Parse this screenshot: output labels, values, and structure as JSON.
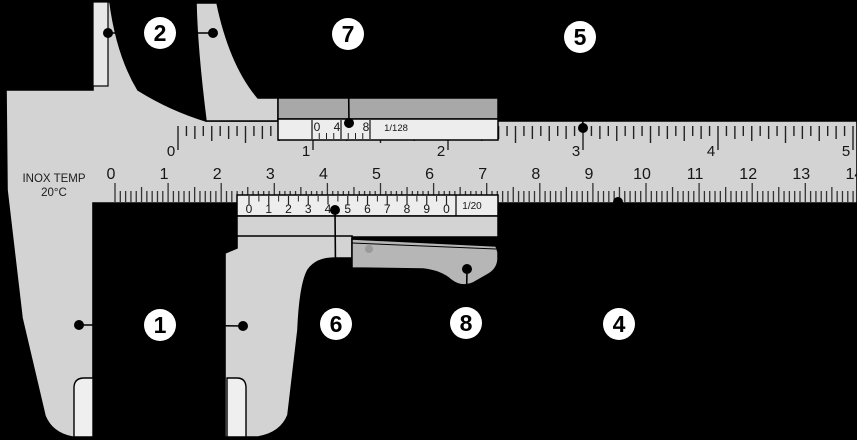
{
  "figure": {
    "type": "vernier-caliper-diagram",
    "background": "#000000"
  },
  "colors": {
    "metal": "#d3d3d3",
    "vernier_plate": "#ededed",
    "clamp_band": "#a8a8a8",
    "thumb_grip": "#b6b6b6",
    "inner_face": "#e7e7e7",
    "measuring_face": "#efefef",
    "tick": "#222222",
    "outline": "#000000",
    "callout_fill": "#ffffff",
    "callout_text": "#000000"
  },
  "engraving": {
    "line1": "INOX TEMP",
    "line2": "20°C"
  },
  "main_scale_inch": {
    "labels": [
      "0",
      "1",
      "2",
      "3",
      "4",
      "5"
    ],
    "subdivisions_per_unit": 16
  },
  "main_scale_cm": {
    "labels": [
      "0",
      "1",
      "2",
      "3",
      "4",
      "5",
      "6",
      "7",
      "8",
      "9",
      "10",
      "11",
      "12",
      "13",
      "14"
    ],
    "subdivisions_per_unit": 10
  },
  "vernier_inch": {
    "labels": [
      "0",
      "4",
      "8"
    ],
    "fraction": "1/128",
    "divisions": 8
  },
  "vernier_mm": {
    "labels": [
      "0",
      "1",
      "2",
      "3",
      "4",
      "5",
      "6",
      "7",
      "8",
      "9",
      "0"
    ],
    "fraction": "1/20",
    "divisions": 10
  },
  "callouts": [
    {
      "label": "1",
      "part": "external-jaws"
    },
    {
      "label": "2",
      "part": "internal-jaws"
    },
    {
      "label": "4",
      "part": "main-scale-cm"
    },
    {
      "label": "5",
      "part": "main-scale-inch"
    },
    {
      "label": "6",
      "part": "vernier-scale-cm"
    },
    {
      "label": "7",
      "part": "vernier-scale-inch"
    },
    {
      "label": "8",
      "part": "thumb-grip"
    }
  ]
}
